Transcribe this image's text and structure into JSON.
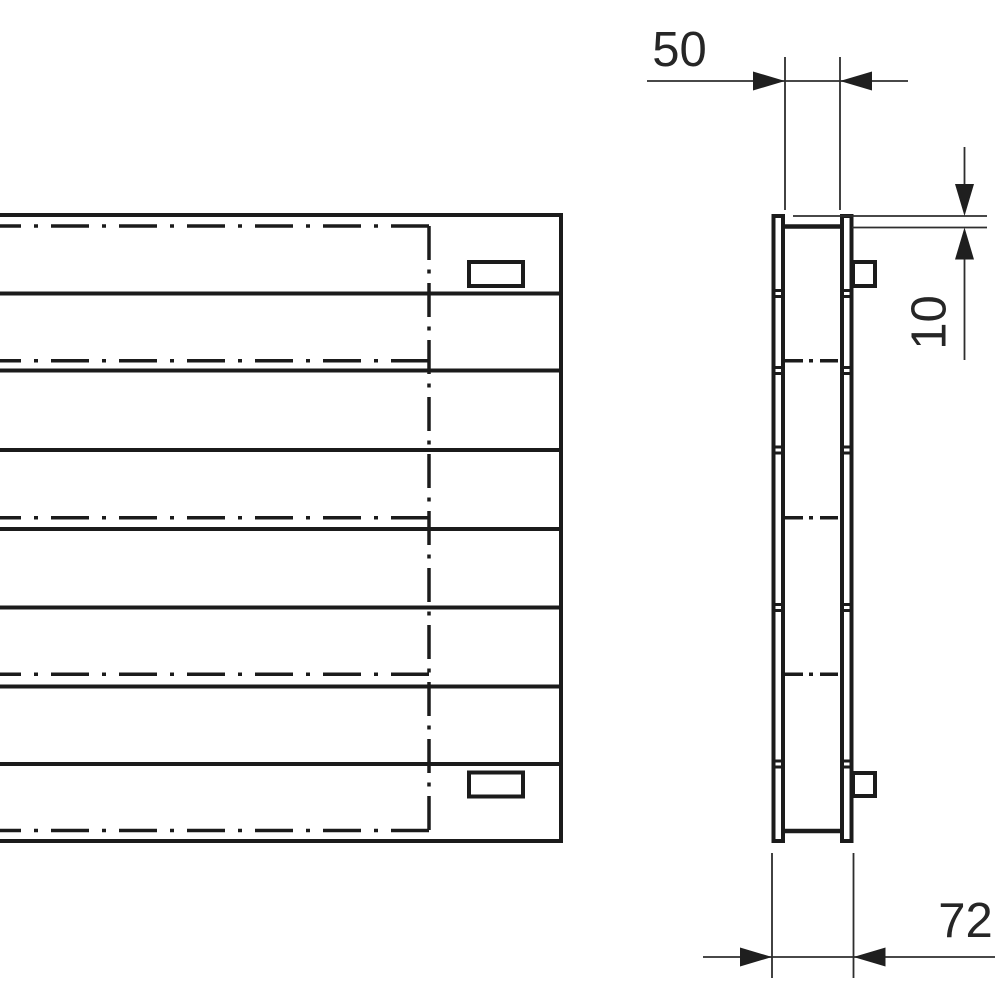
{
  "drawing": {
    "dimensions": {
      "inner_depth": "50",
      "top_offset": "10",
      "overall_depth": "72"
    }
  }
}
